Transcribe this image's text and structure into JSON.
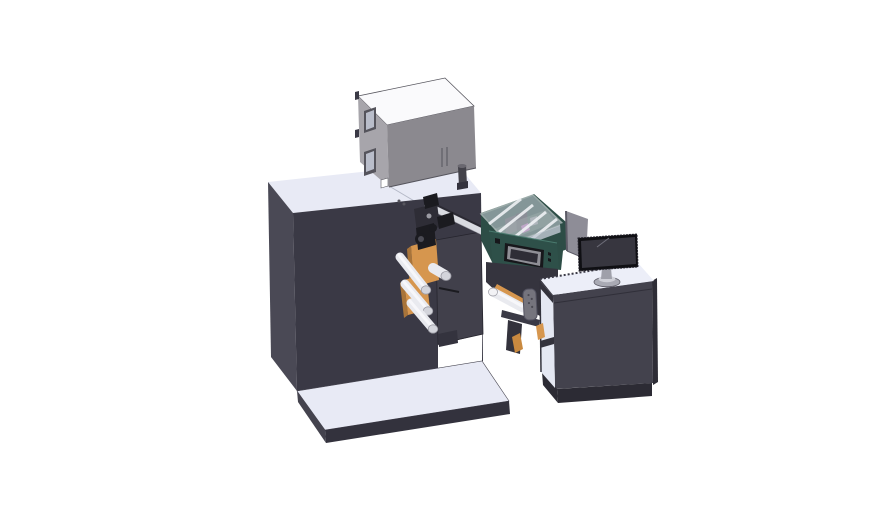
{
  "scene": {
    "type": "3d-cad-render",
    "components": [
      "main-cabinet",
      "base-plinth",
      "electronics-box",
      "box-window",
      "print-head-mechanism",
      "guide-rail",
      "turret-plate",
      "unwinder-orange-plate",
      "guide-roller",
      "applicator-module",
      "transparent-cover",
      "hmi-screen",
      "applicator-bracket",
      "grip-handle",
      "operator-desk",
      "desk-shelf",
      "desk-monitor",
      "monitor-stand",
      "monitor-side-panel"
    ]
  },
  "colors": {
    "background": "#ffffff",
    "cabinet_front": "#3a3945",
    "cabinet_side": "#4a4955",
    "cabinet_top": "#e8eaf5",
    "top_seam": "#b4b8c6",
    "plinth_top": "#e8eaf5",
    "plinth_front": "#33323d",
    "plinth_side": "#44434e",
    "box_top": "#fafafc",
    "box_left": "#a7a5ab",
    "box_front": "#8b898f",
    "box_edge": "#56555d",
    "box_window_frame": "#55545c",
    "box_window_glass": "#b9bdca",
    "box_cylinder": "#43424a",
    "box_cylinder_top": "#6a6870",
    "orange": "#d6964e",
    "orange_dark": "#a8743a",
    "orange_dim": "#c9893f",
    "roller": "#e9eaef",
    "roller_hl": "#f7f7fa",
    "roller_cap": "#d3d4db",
    "roller_cap_hl": "#f2f2f5",
    "roller_edge": "#9a9aa3",
    "plate": "#41404b",
    "plate_foot": "#34333e",
    "mech_dark": "#1b1b20",
    "mech_mid": "#2e2d36",
    "mech_metal": "#9b9ba3",
    "rail": "#d9dbe1",
    "rail_edge": "#2b2a33",
    "teal": "#2d4d46",
    "teal_front": "#2e5049",
    "teal_hl": "#4a7a6e",
    "cover_glass": "#ccd3dc",
    "cover_stripe": "#f4f6f9",
    "cover_band": "#c3cad4",
    "interior_dark": "#3b3b43",
    "interior_mid": "#4c4c55",
    "interior_light": "#8d8d95",
    "interior_tint": "#8da195",
    "magenta": "#c05fbe",
    "screen_bezel": "#17171b",
    "screen_rim": "#8f8f96",
    "screen_inner": "#2e2d36",
    "dark_body": "#35343e",
    "desk_front": "#43424d",
    "desk_side": "#2e2d36",
    "desk_top": "#eceef8",
    "desk_seam": "#302f39",
    "desk_speckle": "#3a3945",
    "desk_interior": "#e4e7f2",
    "desk_dark": "#33323c",
    "desk_plinth": "#2c2b34",
    "panel": "#8e8d97",
    "panel_edge": "#5c5b66",
    "monitor_bezel": "#0f0f13",
    "monitor_screen": "#37363f",
    "monitor_hl": "#6f6f7a",
    "stand": "#a9aab4",
    "stand_top": "#cfd0d8",
    "neck": "#9fa0aa",
    "handle": "#75747d",
    "handle_edge": "#535260",
    "handle_dot": "#4a4952",
    "edge": "#26252e",
    "white": "#ffffff"
  }
}
